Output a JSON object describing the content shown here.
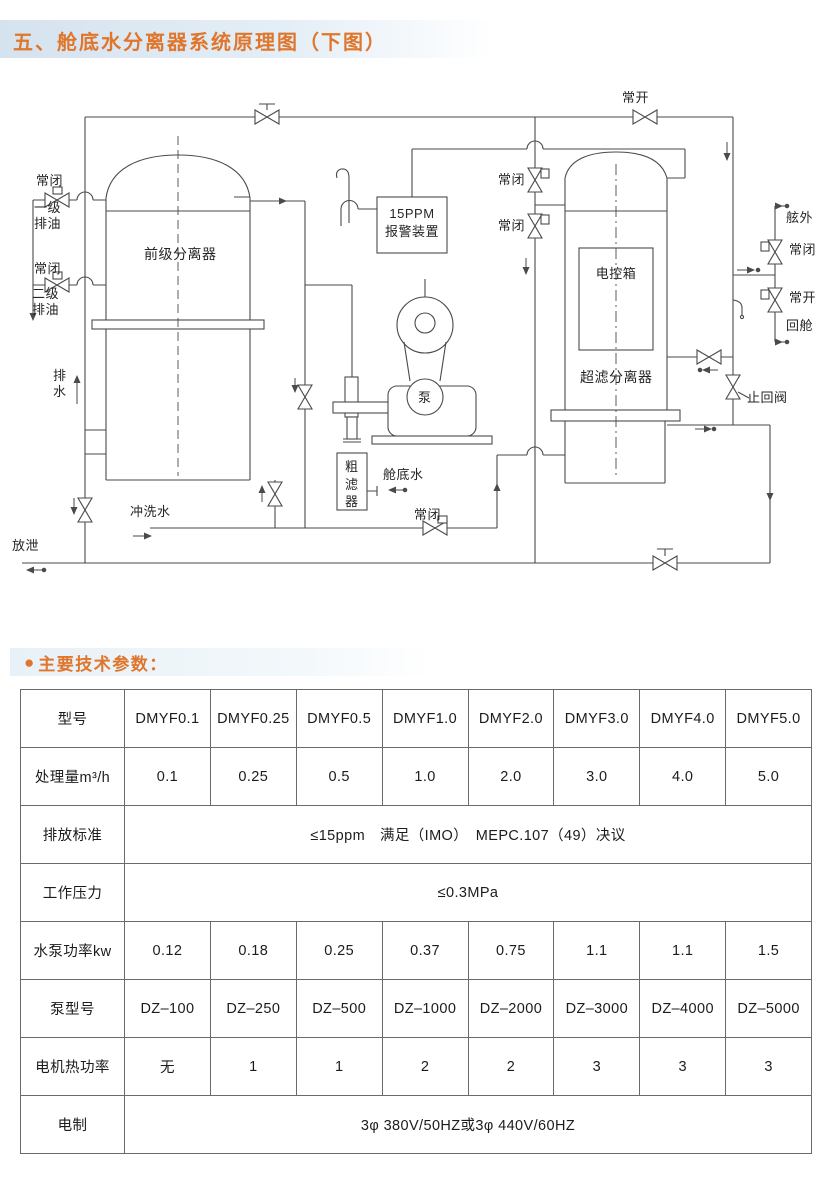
{
  "page": {
    "title": "五、舱底水分离器系统原理图（下图）",
    "section_bullet": "●",
    "section_heading": "主要技术参数："
  },
  "colors": {
    "accent_orange": "#e0762c",
    "title_band_blue": "#d5e3ef",
    "line_gray": "#4a4a4a"
  },
  "diagram": {
    "labels": {
      "nc_left_1": "常闭",
      "stage1_oil": "一级排油",
      "nc_left_2": "常闭",
      "stage2_oil": "二级排油",
      "pre_separator": "前级分离器",
      "drain_water": "排水",
      "flush_water": "冲洗水",
      "vent": "放泄",
      "ppm_line1": "15PPM",
      "ppm_line2": "报警装置",
      "pump": "泵",
      "coarse_filter": "粗滤器",
      "bilge_water": "舱底水",
      "nc_bottom": "常闭",
      "nc_mid_1": "常闭",
      "nc_mid_2": "常闭",
      "no_top": "常开",
      "control_box": "电控箱",
      "uf_separator": "超滤分离器",
      "overboard": "舷外",
      "nc_right": "常闭",
      "no_right": "常开",
      "return_cabin": "回舱",
      "check_valve": "止回阀"
    }
  },
  "table": {
    "rows": [
      {
        "label": "型号",
        "cells": [
          "DMYF0.1",
          "DMYF0.25",
          "DMYF0.5",
          "DMYF1.0",
          "DMYF2.0",
          "DMYF3.0",
          "DMYF4.0",
          "DMYF5.0"
        ]
      },
      {
        "label": "处理量m³/h",
        "cells": [
          "0.1",
          "0.25",
          "0.5",
          "1.0",
          "2.0",
          "3.0",
          "4.0",
          "5.0"
        ]
      },
      {
        "label": "排放标准",
        "span": "≤15ppm　满足（IMO）　MEPC.107（49）决议"
      },
      {
        "label": "工作压力",
        "span": "≤0.3MPa"
      },
      {
        "label": "水泵功率kw",
        "cells": [
          "0.12",
          "0.18",
          "0.25",
          "0.37",
          "0.75",
          "1.1",
          "1.1",
          "1.5"
        ]
      },
      {
        "label": "泵型号",
        "cells": [
          "DZ–100",
          "DZ–250",
          "DZ–500",
          "DZ–1000",
          "DZ–2000",
          "DZ–3000",
          "DZ–4000",
          "DZ–5000"
        ]
      },
      {
        "label": "电机热功率",
        "cells": [
          "无",
          "1",
          "1",
          "2",
          "2",
          "3",
          "3",
          "3"
        ]
      },
      {
        "label": "电制",
        "span": "3φ 380V/50HZ或3φ 440V/60HZ"
      }
    ]
  }
}
